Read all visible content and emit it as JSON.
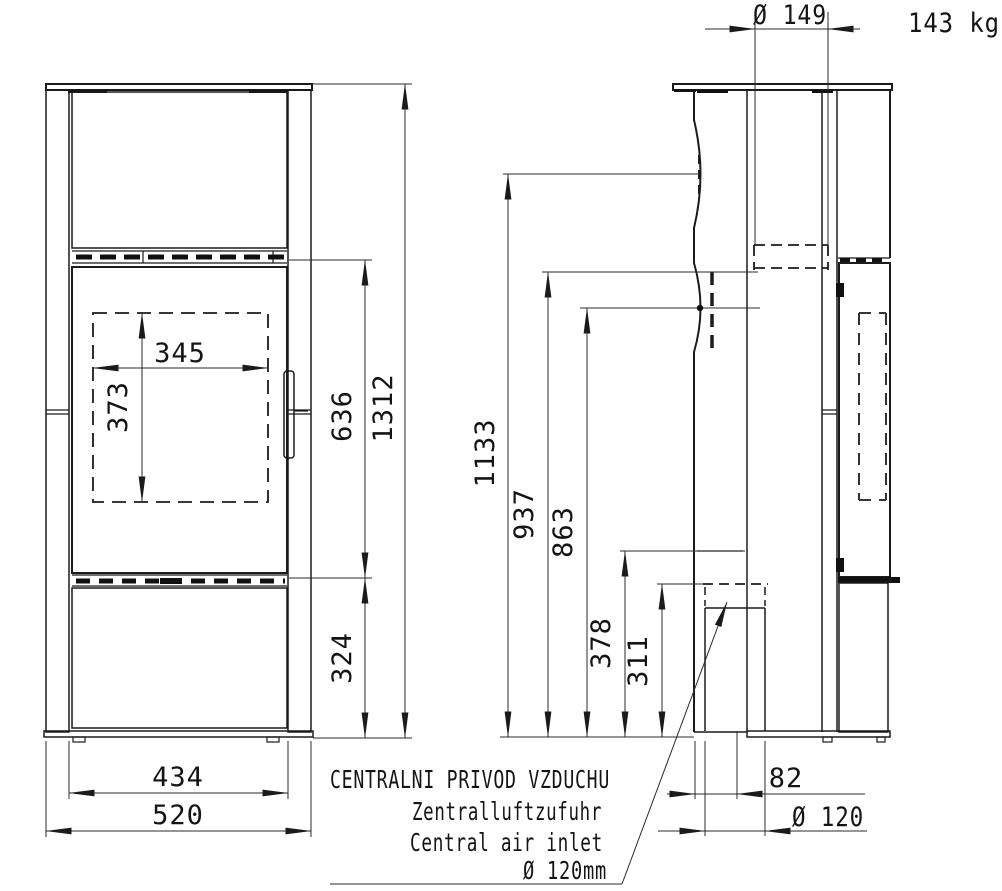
{
  "drawing_title": "Stove dimension drawing (front and side view)",
  "weight_label": "143 kg",
  "front": {
    "glass_width": "345",
    "glass_height": "373",
    "door_zone_height": "636",
    "overall_height": "1312",
    "plinth_height": "324",
    "body_width": "434",
    "overall_width": "520"
  },
  "side": {
    "flue_collar_diameter": "Ø 149",
    "flue_center_height": "1133",
    "height_937": "937",
    "height_863": "863",
    "height_378": "378",
    "height_311": "311",
    "air_inlet_offset": "82",
    "air_inlet_diameter": "Ø 120"
  },
  "air_inlet_note": {
    "czech": "CENTRALNI PRIVOD VZDUCHU",
    "german": "Zentralluftzufuhr",
    "english": "Central air inlet",
    "diameter": "Ø 120mm"
  }
}
